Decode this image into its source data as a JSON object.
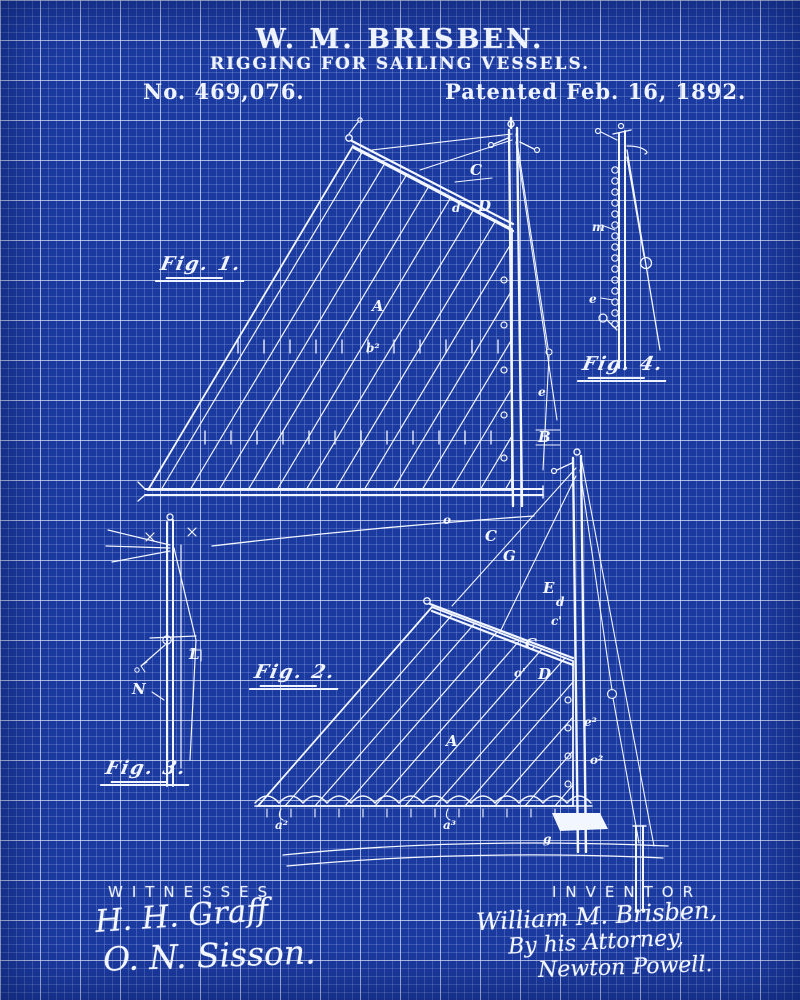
{
  "colors": {
    "background": "#1b3aa0",
    "grid_minor": "#4a66c4",
    "grid_major": "#cdd7ee",
    "ink": "#f2f6fe"
  },
  "header": {
    "inventor_name": "W. M. BRISBEN.",
    "invention_title": "RIGGING FOR SAILING VESSELS.",
    "patent_number": "No. 469,076.",
    "patent_date": "Patented Feb. 16, 1892."
  },
  "figure_labels": {
    "fig1": "Fig. 1.",
    "fig2": "Fig. 2.",
    "fig3": "Fig. 3.",
    "fig4": "Fig. 4."
  },
  "labels": {
    "fig1": [
      "C",
      "d'",
      "D",
      "A",
      "b²",
      "e",
      "B",
      "o",
      "C",
      "G"
    ],
    "fig2": [
      "E",
      "d",
      "c'",
      "C",
      "D",
      "o'",
      "A",
      "e²",
      "o²",
      "g",
      "a²",
      "a³"
    ],
    "fig3": [
      "L",
      "N"
    ],
    "fig4": [
      "m",
      "e"
    ]
  },
  "footer": {
    "witnesses_heading": "WITNESSES",
    "witness_signature_1": "H. H. Graff",
    "witness_signature_2": "O. N. Sisson.",
    "inventor_heading": "INVENTOR",
    "inventor_signature": "William M. Brisben,",
    "attorney_line": "By his Attorney,",
    "attorney_signature": "Newton Powell."
  }
}
